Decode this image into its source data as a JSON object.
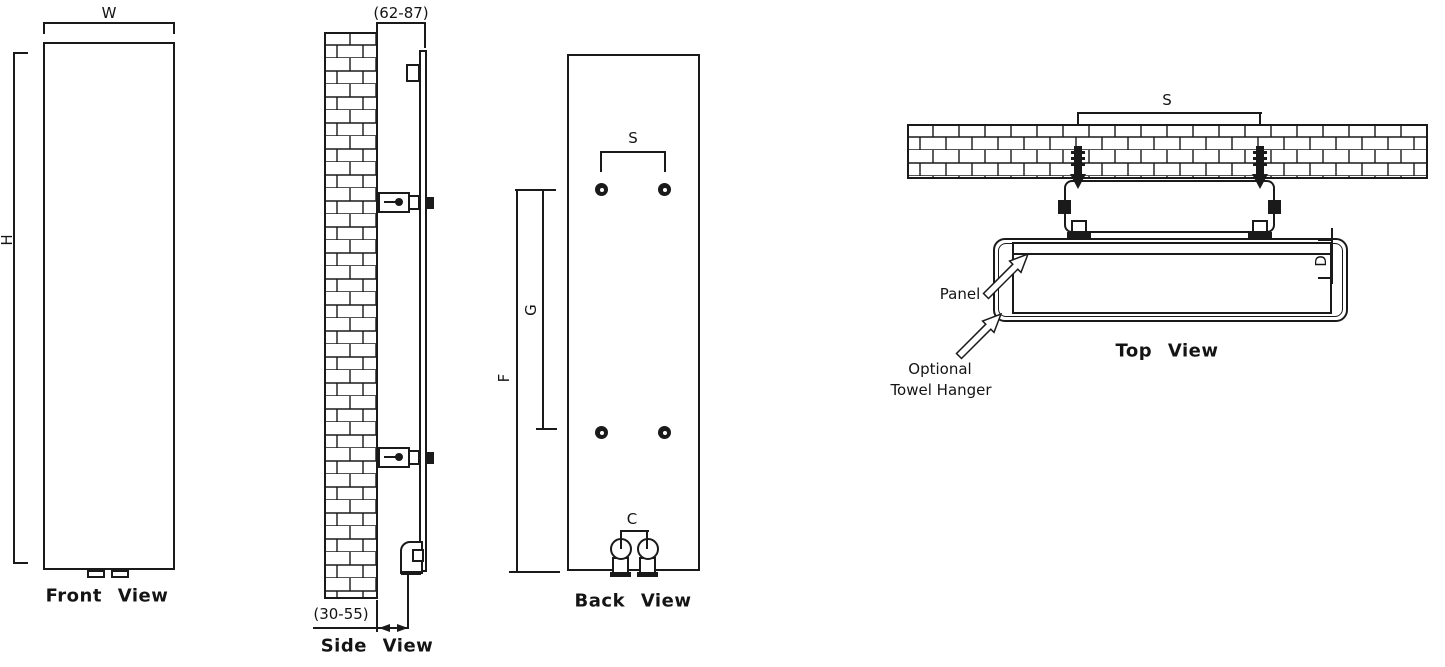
{
  "drawing": {
    "front_view": {
      "title": "Front View",
      "width_label": "W",
      "height_label": "H"
    },
    "side_view": {
      "title": "Side View",
      "wall_clearance_label": "(62-87)",
      "pipe_offset_label": "(30-55)"
    },
    "back_view": {
      "title": "Back View",
      "bracket_span_label": "S",
      "upper_bracket_label": "G",
      "lower_bracket_label": "F",
      "connection_span_label": "C"
    },
    "top_view": {
      "title": "Top View",
      "bracket_span_label": "S",
      "depth_label": "D",
      "panel_label": "Panel",
      "towel_hanger_label_line1": "Optional",
      "towel_hanger_label_line2": "Towel Hanger"
    },
    "colors": {
      "ink": "#1a1a1a",
      "paper": "#ffffff"
    }
  }
}
